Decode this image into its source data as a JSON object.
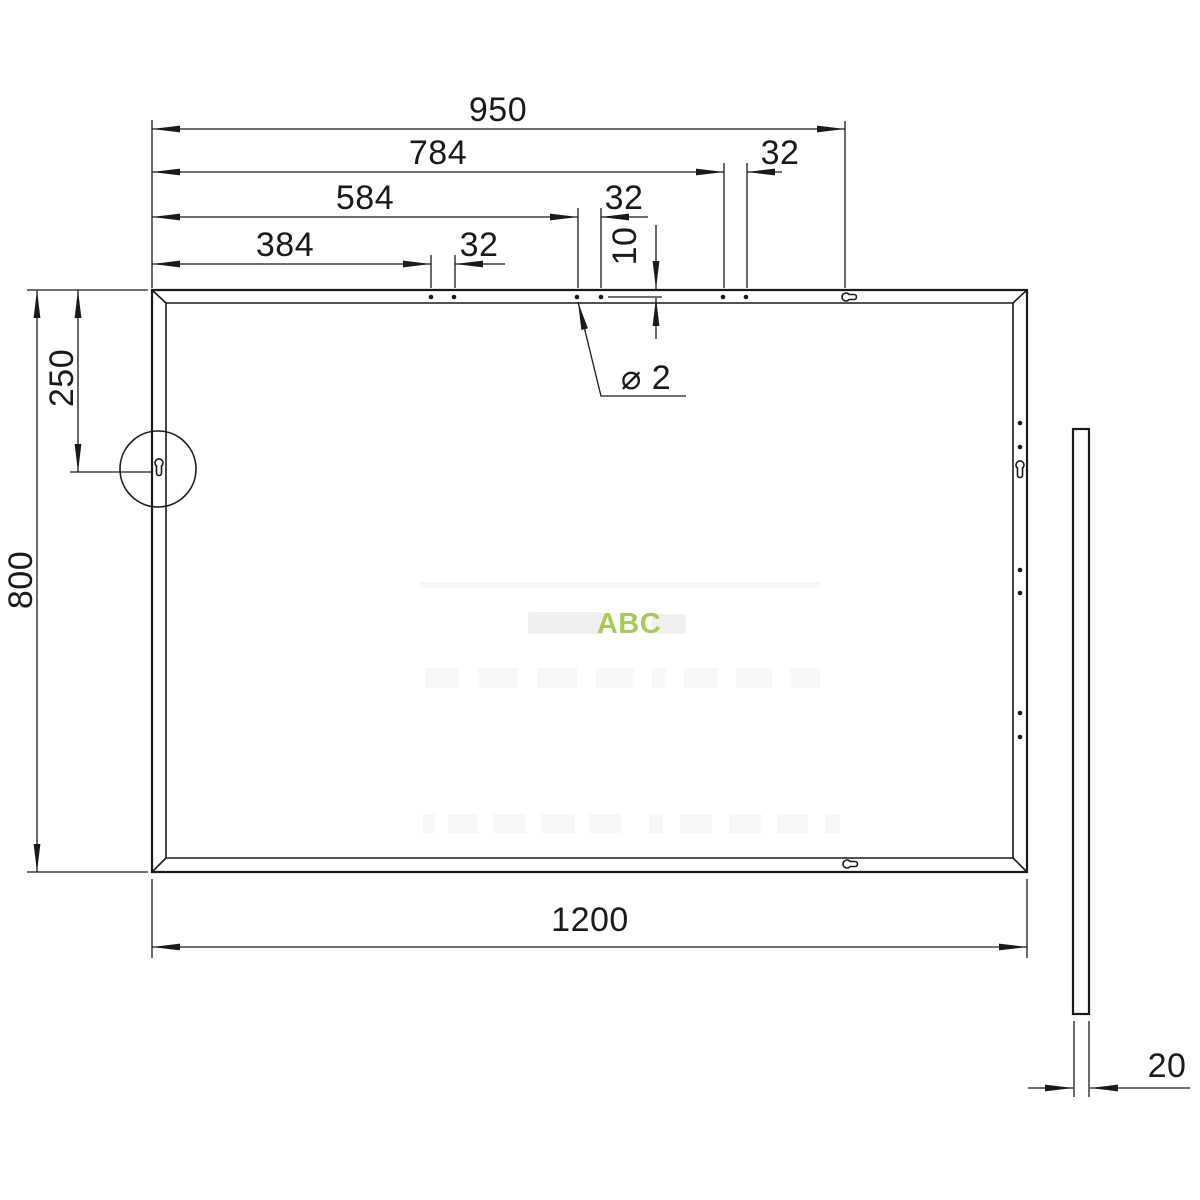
{
  "front_view": {
    "overall_width": "1200",
    "overall_height": "800",
    "keyhole_offset_from_top": "250",
    "top_dims": {
      "to_keyhole": "950",
      "to_hole_pair_3": "784",
      "pair_3_pitch": "32",
      "to_hole_pair_2": "584",
      "pair_2_pitch": "32",
      "to_hole_pair_1": "384",
      "pair_1_pitch": "32"
    },
    "hole_edge_offset": "10",
    "hole_diameter": "⌀ 2"
  },
  "side_view": {
    "thickness": "20"
  },
  "watermark": {
    "brand": "ABC",
    "brand_color": "#a6cb57"
  }
}
